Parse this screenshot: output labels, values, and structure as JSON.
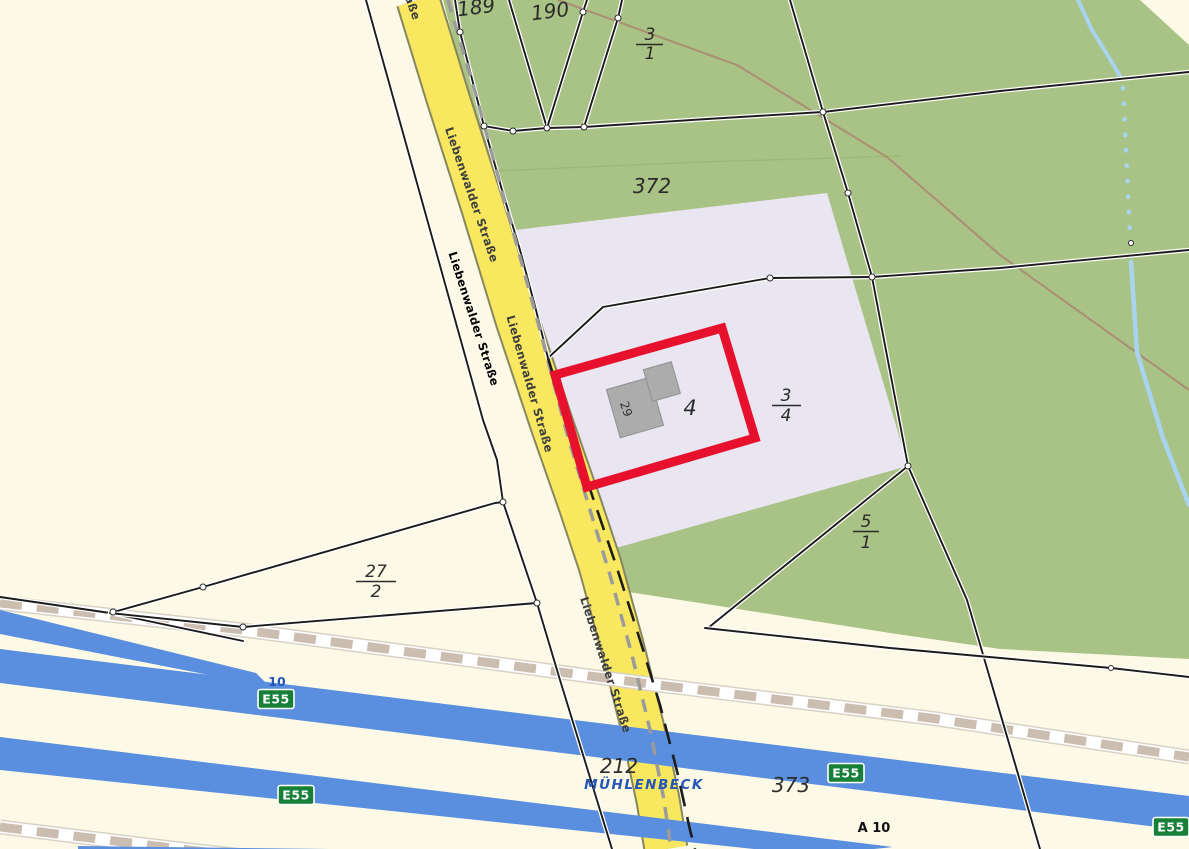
{
  "map_labels": {
    "street_name": "Liebenwalder Straße",
    "place_name": "MÜHLENBECK",
    "motorway_name": "A 10",
    "motorway_exit_number": "10",
    "shields": [
      "E55",
      "E55",
      "E55",
      "E55"
    ],
    "parcel_189": "189",
    "parcel_190": "190",
    "parcel_372": "372",
    "parcel_212": "212",
    "parcel_373": "373",
    "parcel_3_1": {
      "num": "3",
      "den": "1"
    },
    "parcel_3_4": {
      "num": "3",
      "den": "4"
    },
    "parcel_5_1": {
      "num": "5",
      "den": "1"
    },
    "parcel_27_2": {
      "num": "27",
      "den": "2"
    },
    "house_number": "4",
    "building_number": "29"
  },
  "colors": {
    "background_cream": "#FCFAE6",
    "field_green": "#A9C285",
    "residential_lavender": "#E9E5F1",
    "road_yellow": "#F9E85F",
    "motorway_blue": "#5A8EDE",
    "water_blue": "#A8D4F0",
    "railway_beige": "#CBBEB1",
    "selection_red": "#E8112D",
    "building_gray": "#ACACAC",
    "shield_green": "#168039",
    "place_text_blue": "#2655B8",
    "brown_line": "#AB8E74"
  }
}
